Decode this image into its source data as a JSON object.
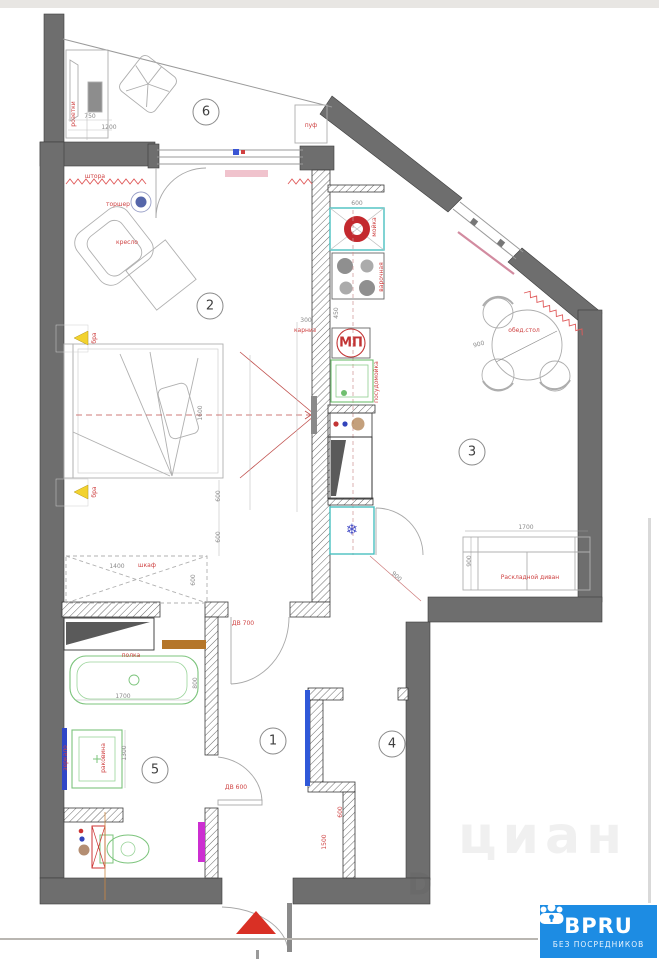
{
  "logo": {
    "brand": "BPRU",
    "tagline": "БЕЗ ПОСРЕДНИКОВ",
    "bg": "#1d8ce3"
  },
  "watermark": {
    "text": "циан",
    "letter": "D"
  },
  "icons": {
    "snowflake": "❄"
  },
  "rooms": [
    {
      "num": "1"
    },
    {
      "num": "2"
    },
    {
      "num": "3"
    },
    {
      "num": "4"
    },
    {
      "num": "5"
    },
    {
      "num": "6"
    }
  ],
  "labels": {
    "sockets": "розетки",
    "pouf": "пуф",
    "curtain": "штора",
    "floor_lamp": "торшер",
    "armchair": "кресло",
    "sconce_top": "бра",
    "sconce_bottom": "бра",
    "cornice": "карниз",
    "wardrobe": "шкаф",
    "kitchen_sink": "мойка",
    "hob": "варочная",
    "microwave": "МП",
    "dishwasher": "посудомойка",
    "dining_table": "обед.стол",
    "sofa": "Раскладной диван",
    "shelf": "полка",
    "mirror": "зеркало",
    "washbasin": "раковина",
    "door_700": "ДВ 700",
    "door_600": "ДВ 600"
  },
  "dims": {
    "desk_width": "750",
    "desk_length": "1200",
    "sink_width": "600",
    "hob_gap": "450",
    "tv_offset": "300",
    "bed_width": "1600",
    "bed_gap_a": "600",
    "bed_gap_b": "600",
    "wardrobe_width": "1400",
    "wardrobe_depth": "600",
    "tub_length": "1700",
    "tub_width": "800",
    "vanity_width": "1300",
    "table_diameter": "900",
    "sofa_width": "1700",
    "sofa_depth": "900",
    "door_swing": "900",
    "hall_niche": "1500",
    "hall_depth": "600"
  }
}
